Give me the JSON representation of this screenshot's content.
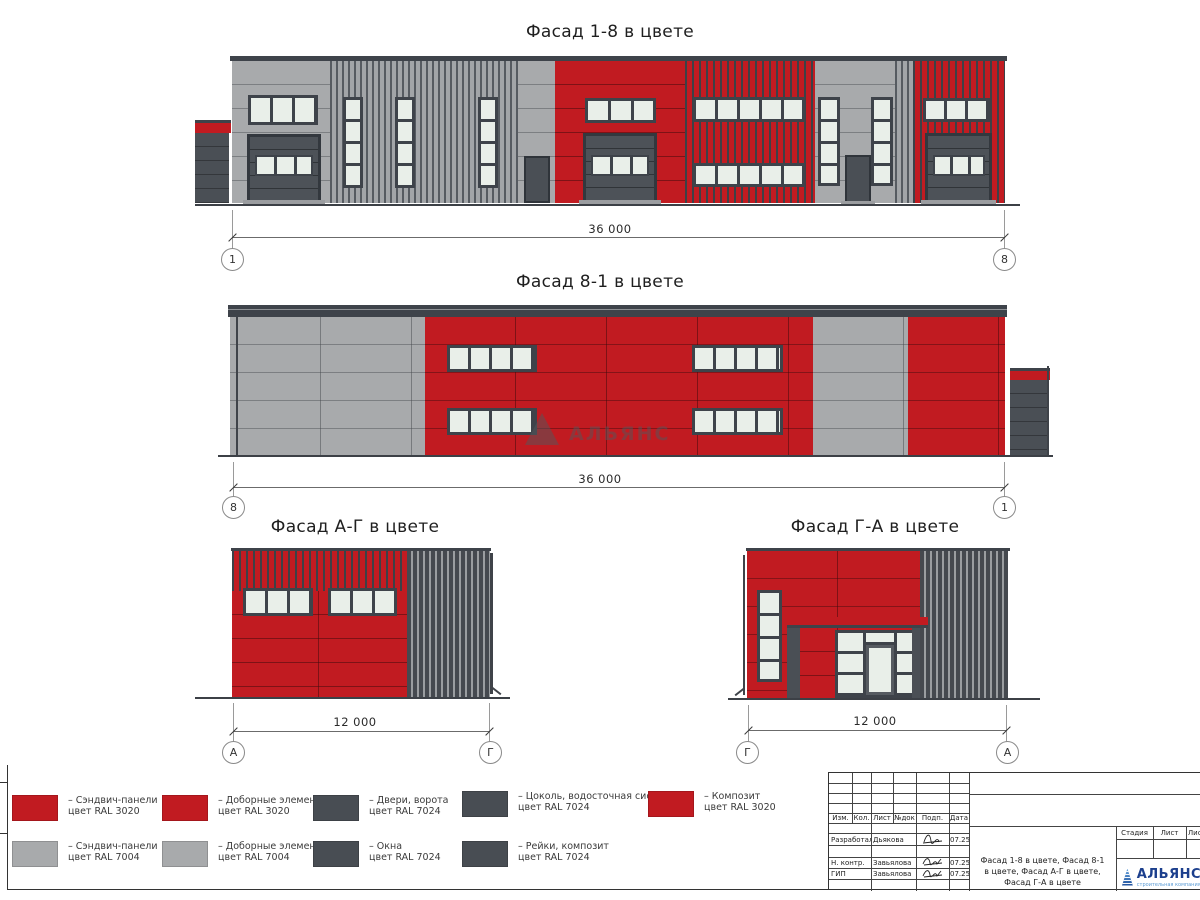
{
  "colors": {
    "ral3020": "#c11b21",
    "ral7004": "#a8aaac",
    "ral7024": "#484d53"
  },
  "facades": {
    "f18": {
      "title": "Фасад 1-8 в цвете",
      "dim": "36 000",
      "axis_left": "1",
      "axis_right": "8"
    },
    "f81": {
      "title": "Фасад 8-1 в цвете",
      "dim": "36 000",
      "axis_left": "8",
      "axis_right": "1"
    },
    "fag": {
      "title": "Фасад А-Г в цвете",
      "dim": "12 000",
      "axis_left": "А",
      "axis_right": "Г"
    },
    "fga": {
      "title": "Фасад Г-А в цвете",
      "dim": "12 000",
      "axis_left": "Г",
      "axis_right": "А"
    }
  },
  "watermark": {
    "text": "АЛЬЯНС"
  },
  "legend": {
    "row1": [
      {
        "color": "ral3020",
        "line1": "– Сэндвич-панели",
        "line2": "цвет RAL 3020"
      },
      {
        "color": "ral3020",
        "line1": "– Доборные элементы",
        "line2": "цвет RAL 3020"
      },
      {
        "color": "ral7024",
        "line1": "– Двери, ворота",
        "line2": "цвет RAL 7024"
      },
      {
        "color": "ral7024",
        "line1": "– Цоколь, водосточная система",
        "line2": "цвет RAL 7024"
      },
      {
        "color": "ral3020",
        "line1": "– Композит",
        "line2": "цвет RAL 3020"
      }
    ],
    "row2": [
      {
        "color": "ral7004",
        "line1": "– Сэндвич-панели",
        "line2": "цвет RAL 7004"
      },
      {
        "color": "ral7004",
        "line1": "– Доборные элементы",
        "line2": "цвет RAL 7004"
      },
      {
        "color": "ral7024",
        "line1": "– Окна",
        "line2": "цвет RAL 7024"
      },
      {
        "color": "ral7024",
        "line1": "– Рейки, композит",
        "line2": "цвет RAL 7024"
      }
    ]
  },
  "titleblock": {
    "columns": [
      "Изм.",
      "Кол.",
      "Лист",
      "№док",
      "Подп.",
      "Дата"
    ],
    "rows": [
      {
        "role": "Разработал",
        "name": "Дьякова",
        "date": "07.25"
      },
      {
        "role": "Н. контр.",
        "name": "Завьялова",
        "date": "07.25"
      },
      {
        "role": "ГИП",
        "name": "Завьялова",
        "date": "07.25"
      }
    ],
    "doc_title_line1": "Фасад 1-8 в цвете, Фасад 8-1",
    "doc_title_line2": "в цвете, Фасад А-Г в цвете,",
    "doc_title_line3": "Фасад Г-А в цвете",
    "stage_label": "Стадия",
    "sheet_label": "Лист",
    "sheets_label": "Листов",
    "company": "АЛЬЯНС",
    "company_sub": "строительная компания"
  }
}
